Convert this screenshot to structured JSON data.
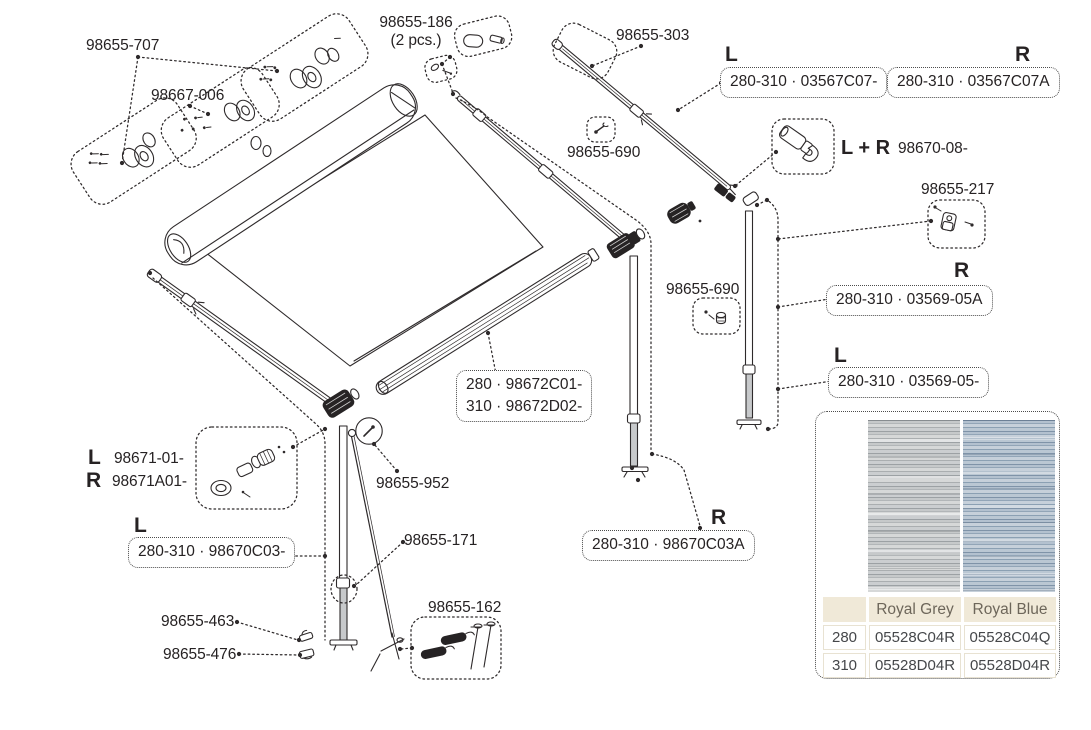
{
  "sides": {
    "left": "L",
    "right": "R",
    "both": "L + R"
  },
  "parts": {
    "p707": "98655-707",
    "p667006": "98667-006",
    "p186": "98655-186",
    "p186qty": "(2 pcs.)",
    "p303": "98655-303",
    "p690": "98655-690",
    "p67008": "98670-08-",
    "p217": "98655-217",
    "p671L": "98671-01-",
    "p671R": "98671A01-",
    "p952": "98655-952",
    "p171": "98655-171",
    "p463": "98655-463",
    "p476": "98655-476",
    "p162": "98655-162"
  },
  "codes": {
    "frontBarL": "280-310 · 03567C07-",
    "frontBarR": "280-310 · 03567C07A",
    "rafterR": "280-310 · 03569-05A",
    "rafterL": "280-310 · 03569-05-",
    "roller280": "280 · 98672C01-",
    "roller310": "310 · 98672D02-",
    "legL": "280-310 · 98670C03-",
    "legR": "280-310 · 98670C03A"
  },
  "fabric_table": {
    "col_grey": "Royal Grey",
    "col_blue": "Royal Blue",
    "rows": [
      {
        "size": "280",
        "grey": "05528C04R",
        "blue": "05528C04Q"
      },
      {
        "size": "310",
        "grey": "05528D04R",
        "blue": "05528D04R"
      }
    ]
  },
  "icons": {
    "swatch_grey": "royal-grey-fabric-swatch",
    "swatch_blue": "royal-blue-fabric-swatch"
  },
  "colors": {
    "ink": "#2e2a2b",
    "table-head-bg": "#f0e9d8",
    "table-head-text": "#6d665a",
    "table-cell-text": "#45474a",
    "table-cell-border": "#e8e2d2",
    "grey-a": "#9ca1a4",
    "grey-b": "#c6c9ca",
    "grey-c": "#b2b6b8",
    "grey-d": "#d6d8d8",
    "grey-e": "#aaaeb0",
    "grey-f": "#cbced0",
    "blue-a": "#7f93a8",
    "blue-b": "#b3c1cf",
    "blue-c": "#92a5b7",
    "blue-d": "#c6d0da",
    "blue-e": "#8ba0b3",
    "blue-f": "#bac7d3"
  }
}
